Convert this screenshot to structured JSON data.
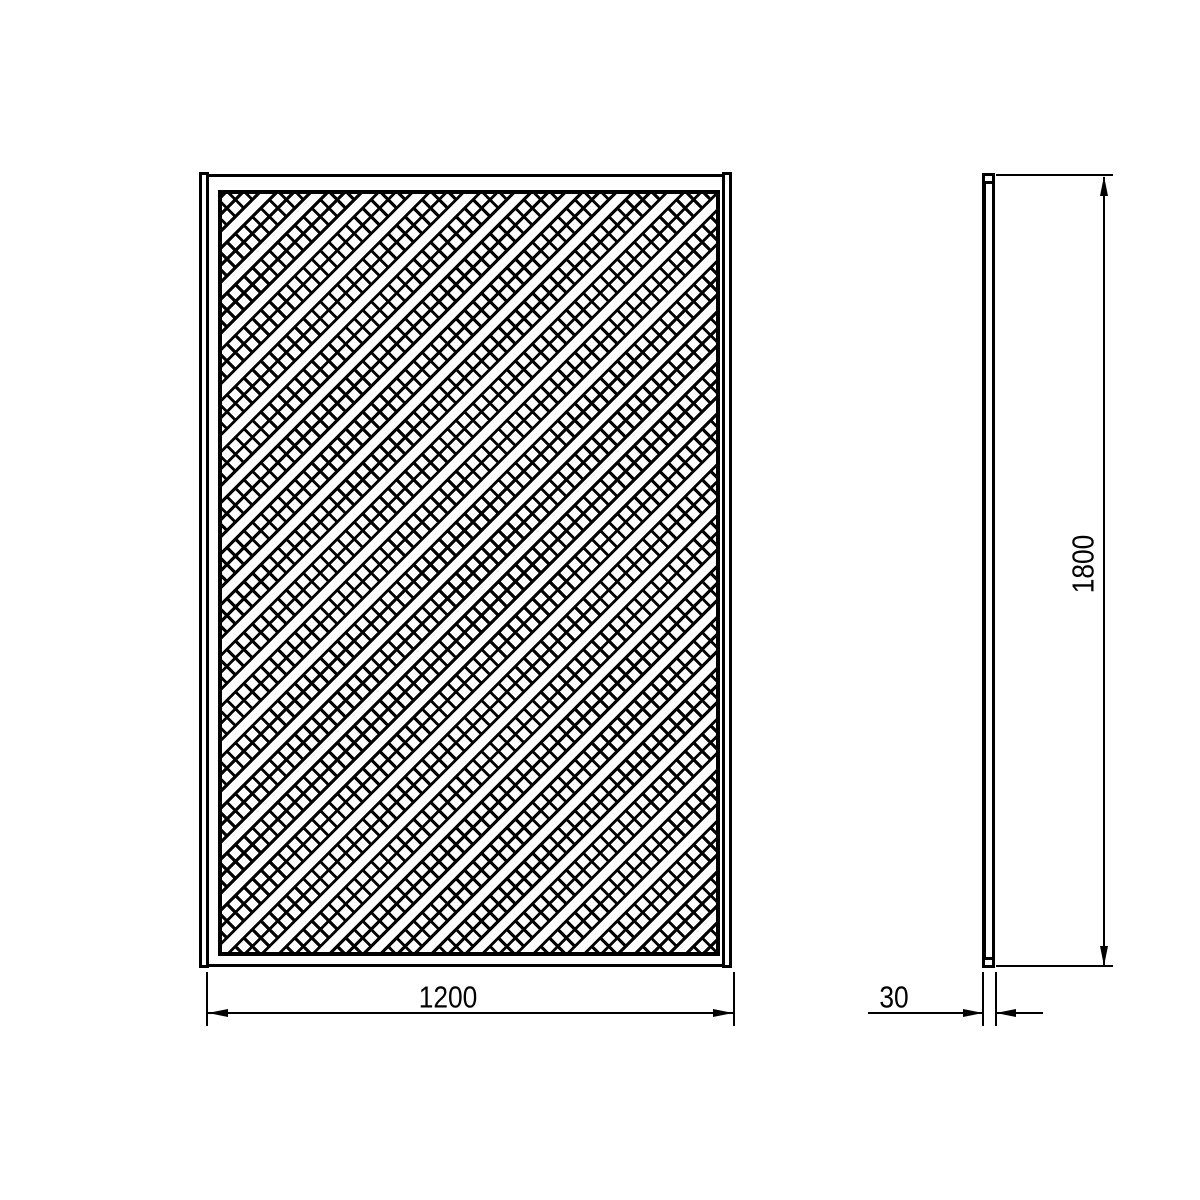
{
  "drawing": {
    "type": "technical-drawing",
    "subject": "diagonal-lattice-trellis-panel",
    "colors": {
      "line": "#000000",
      "background": "#ffffff"
    },
    "views": {
      "front": {
        "label": "front-view"
      },
      "side": {
        "label": "side-view"
      }
    },
    "dimensions": {
      "width": {
        "value": "1200"
      },
      "height": {
        "value": "1800"
      },
      "thickness": {
        "value": "30"
      }
    }
  }
}
